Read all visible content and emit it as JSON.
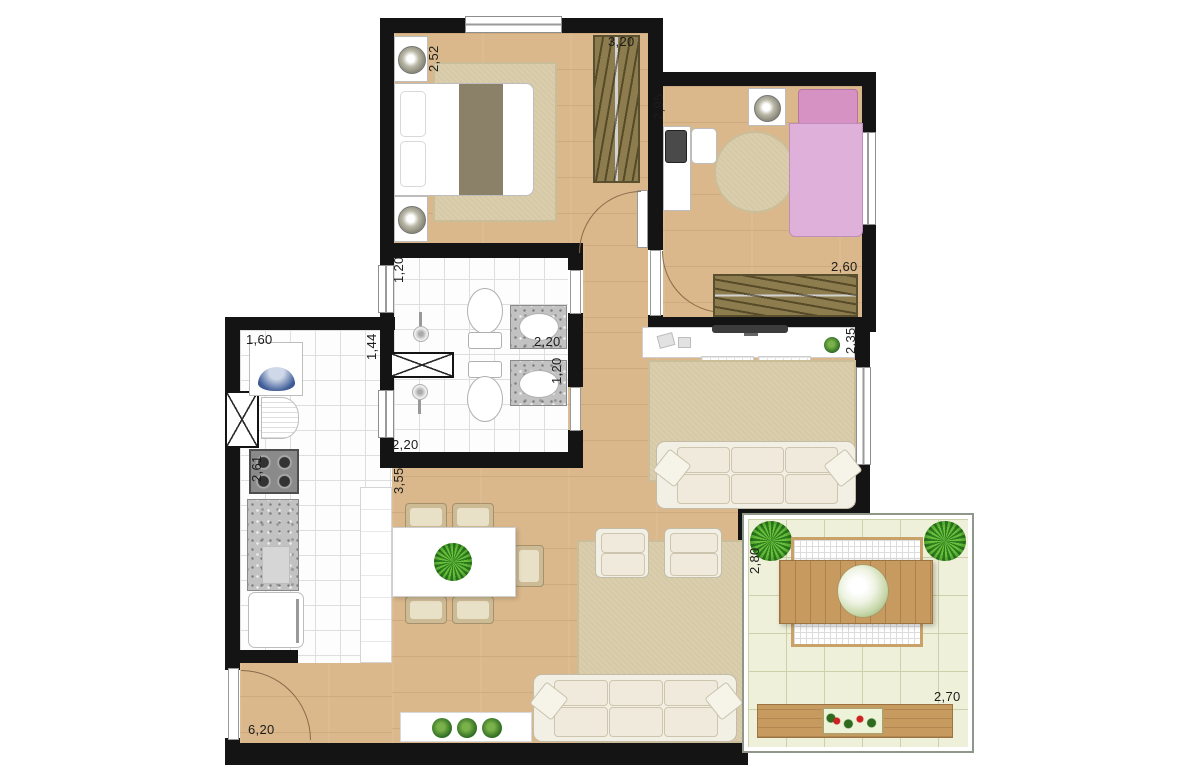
{
  "plan_title": "2-bedroom apartment floor plan with balcony",
  "dimensions": {
    "bedroom1_depth": "2,52",
    "bedroom1_width": "3,20",
    "bedroom2_depth": "2,95",
    "bedroom2_width": "2,60",
    "bath1_door": "1,20",
    "bath1_width": "2,20",
    "bath2_sink": "1,20",
    "bath2_width": "2,20",
    "service_width": "1,44",
    "hall_length": "3,55",
    "laundry_width": "1,60",
    "kitchen_length": "2,61",
    "living_length": "6,20",
    "living_width": "2,35",
    "balcony_depth": "2,80",
    "balcony_width": "2,70"
  },
  "palette": {
    "wall": "#141414",
    "wood_floor": "#dab88c",
    "tile_floor": "#fdfdfd",
    "balcony_tile": "#eff0da",
    "rug": "#d6c9a6",
    "wardrobe": "#8d7d4e",
    "bed2_pink": "#dfb0da",
    "furniture_wood": "#c79a60",
    "plant_green": "#2f6d22"
  }
}
